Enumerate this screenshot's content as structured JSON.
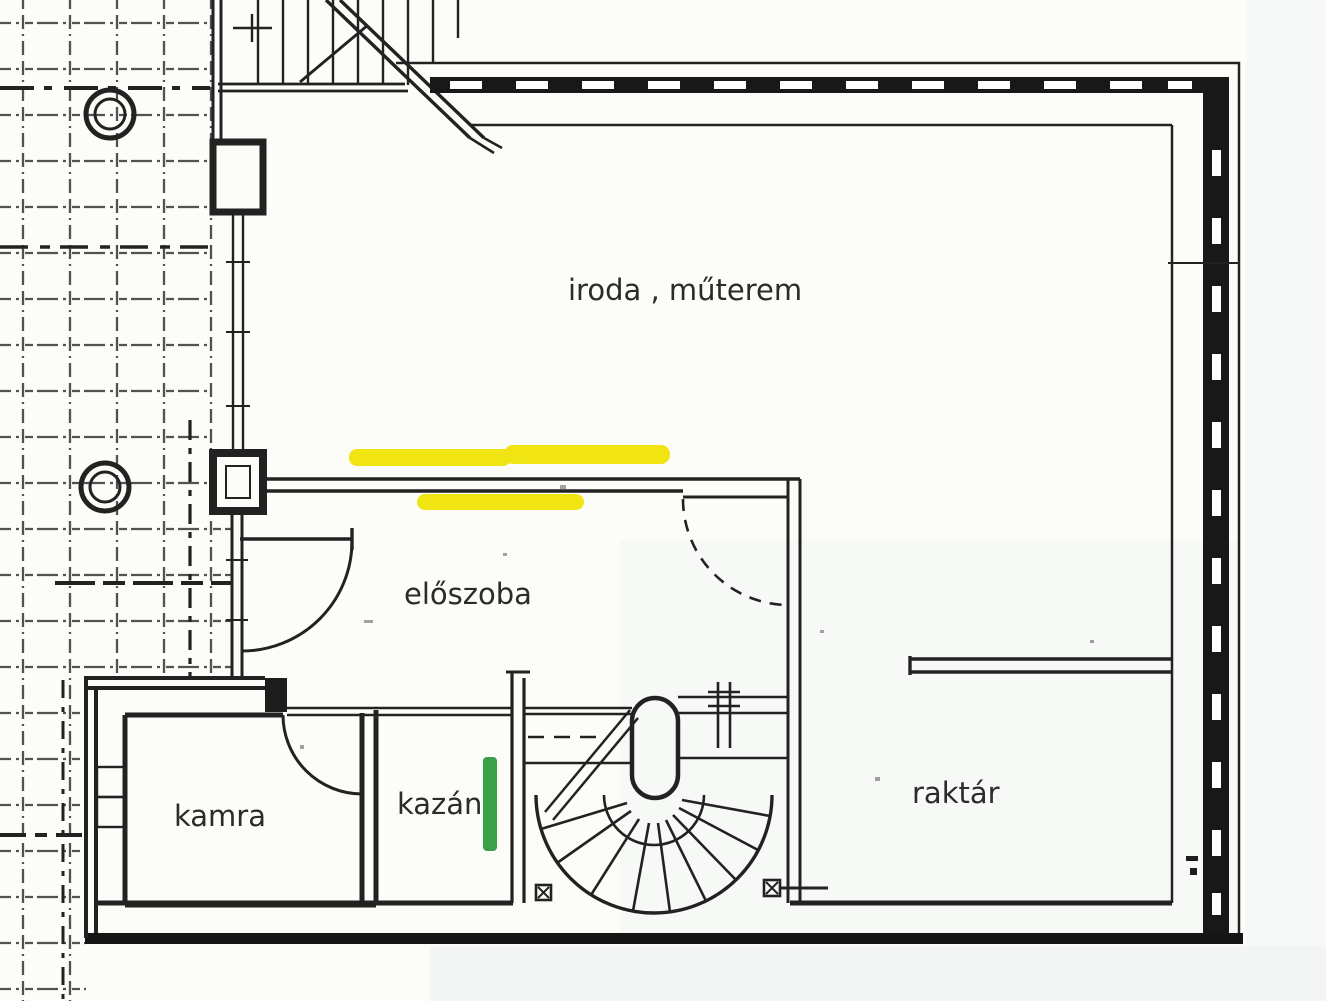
{
  "plan": {
    "type": "floor-plan",
    "rooms": {
      "iroda": {
        "label": "iroda , műterem"
      },
      "eloszoba": {
        "label": "előszoba"
      },
      "kamra": {
        "label": "kamra"
      },
      "kazan": {
        "label": "kazán"
      },
      "raktar": {
        "label": "raktár"
      }
    },
    "highlights": {
      "yellow": "#f0e412",
      "green": "#3aa14b"
    },
    "drawing": {
      "ink": "#222222",
      "paper": "#fcfcf9"
    }
  }
}
